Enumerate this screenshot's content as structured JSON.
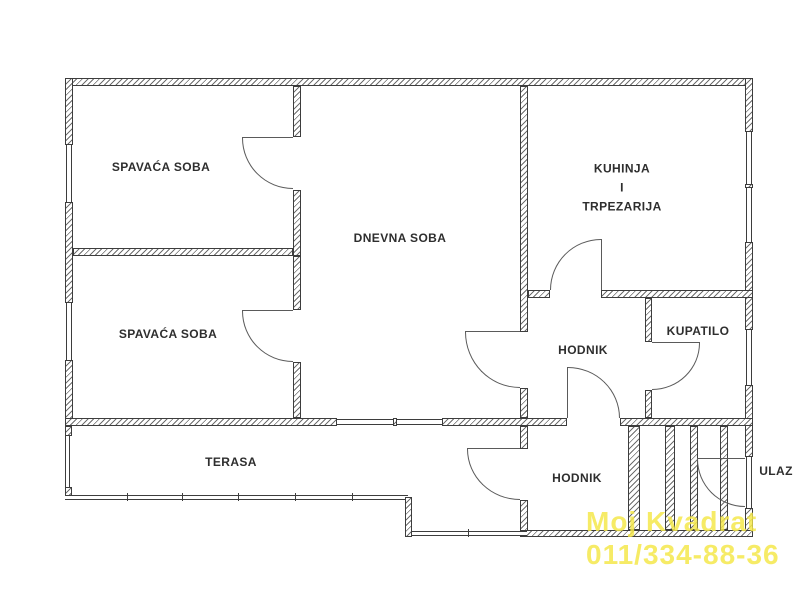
{
  "plan": {
    "rooms": {
      "bedroom1": "SPAVAĆA SOBA",
      "bedroom2": "SPAVAĆA SOBA",
      "living_room": "DNEVNA SOBA",
      "kitchen_line1": "KUHINJA",
      "kitchen_line2": "I",
      "kitchen_line3": "TRPEZARIJA",
      "hall_upper": "HODNIK",
      "bathroom": "KUPATILO",
      "terrace": "TERASA",
      "hall_lower": "HODNIK",
      "entrance": "ULAZ"
    },
    "watermark": {
      "line1": "Moj Kvadrat",
      "line2": "011/334-88-36",
      "color": "#f4e84b"
    },
    "colors": {
      "wall_outline": "#3d3d3d",
      "hatch": "#6e6e6e",
      "label_text": "#2e2e2e"
    }
  }
}
